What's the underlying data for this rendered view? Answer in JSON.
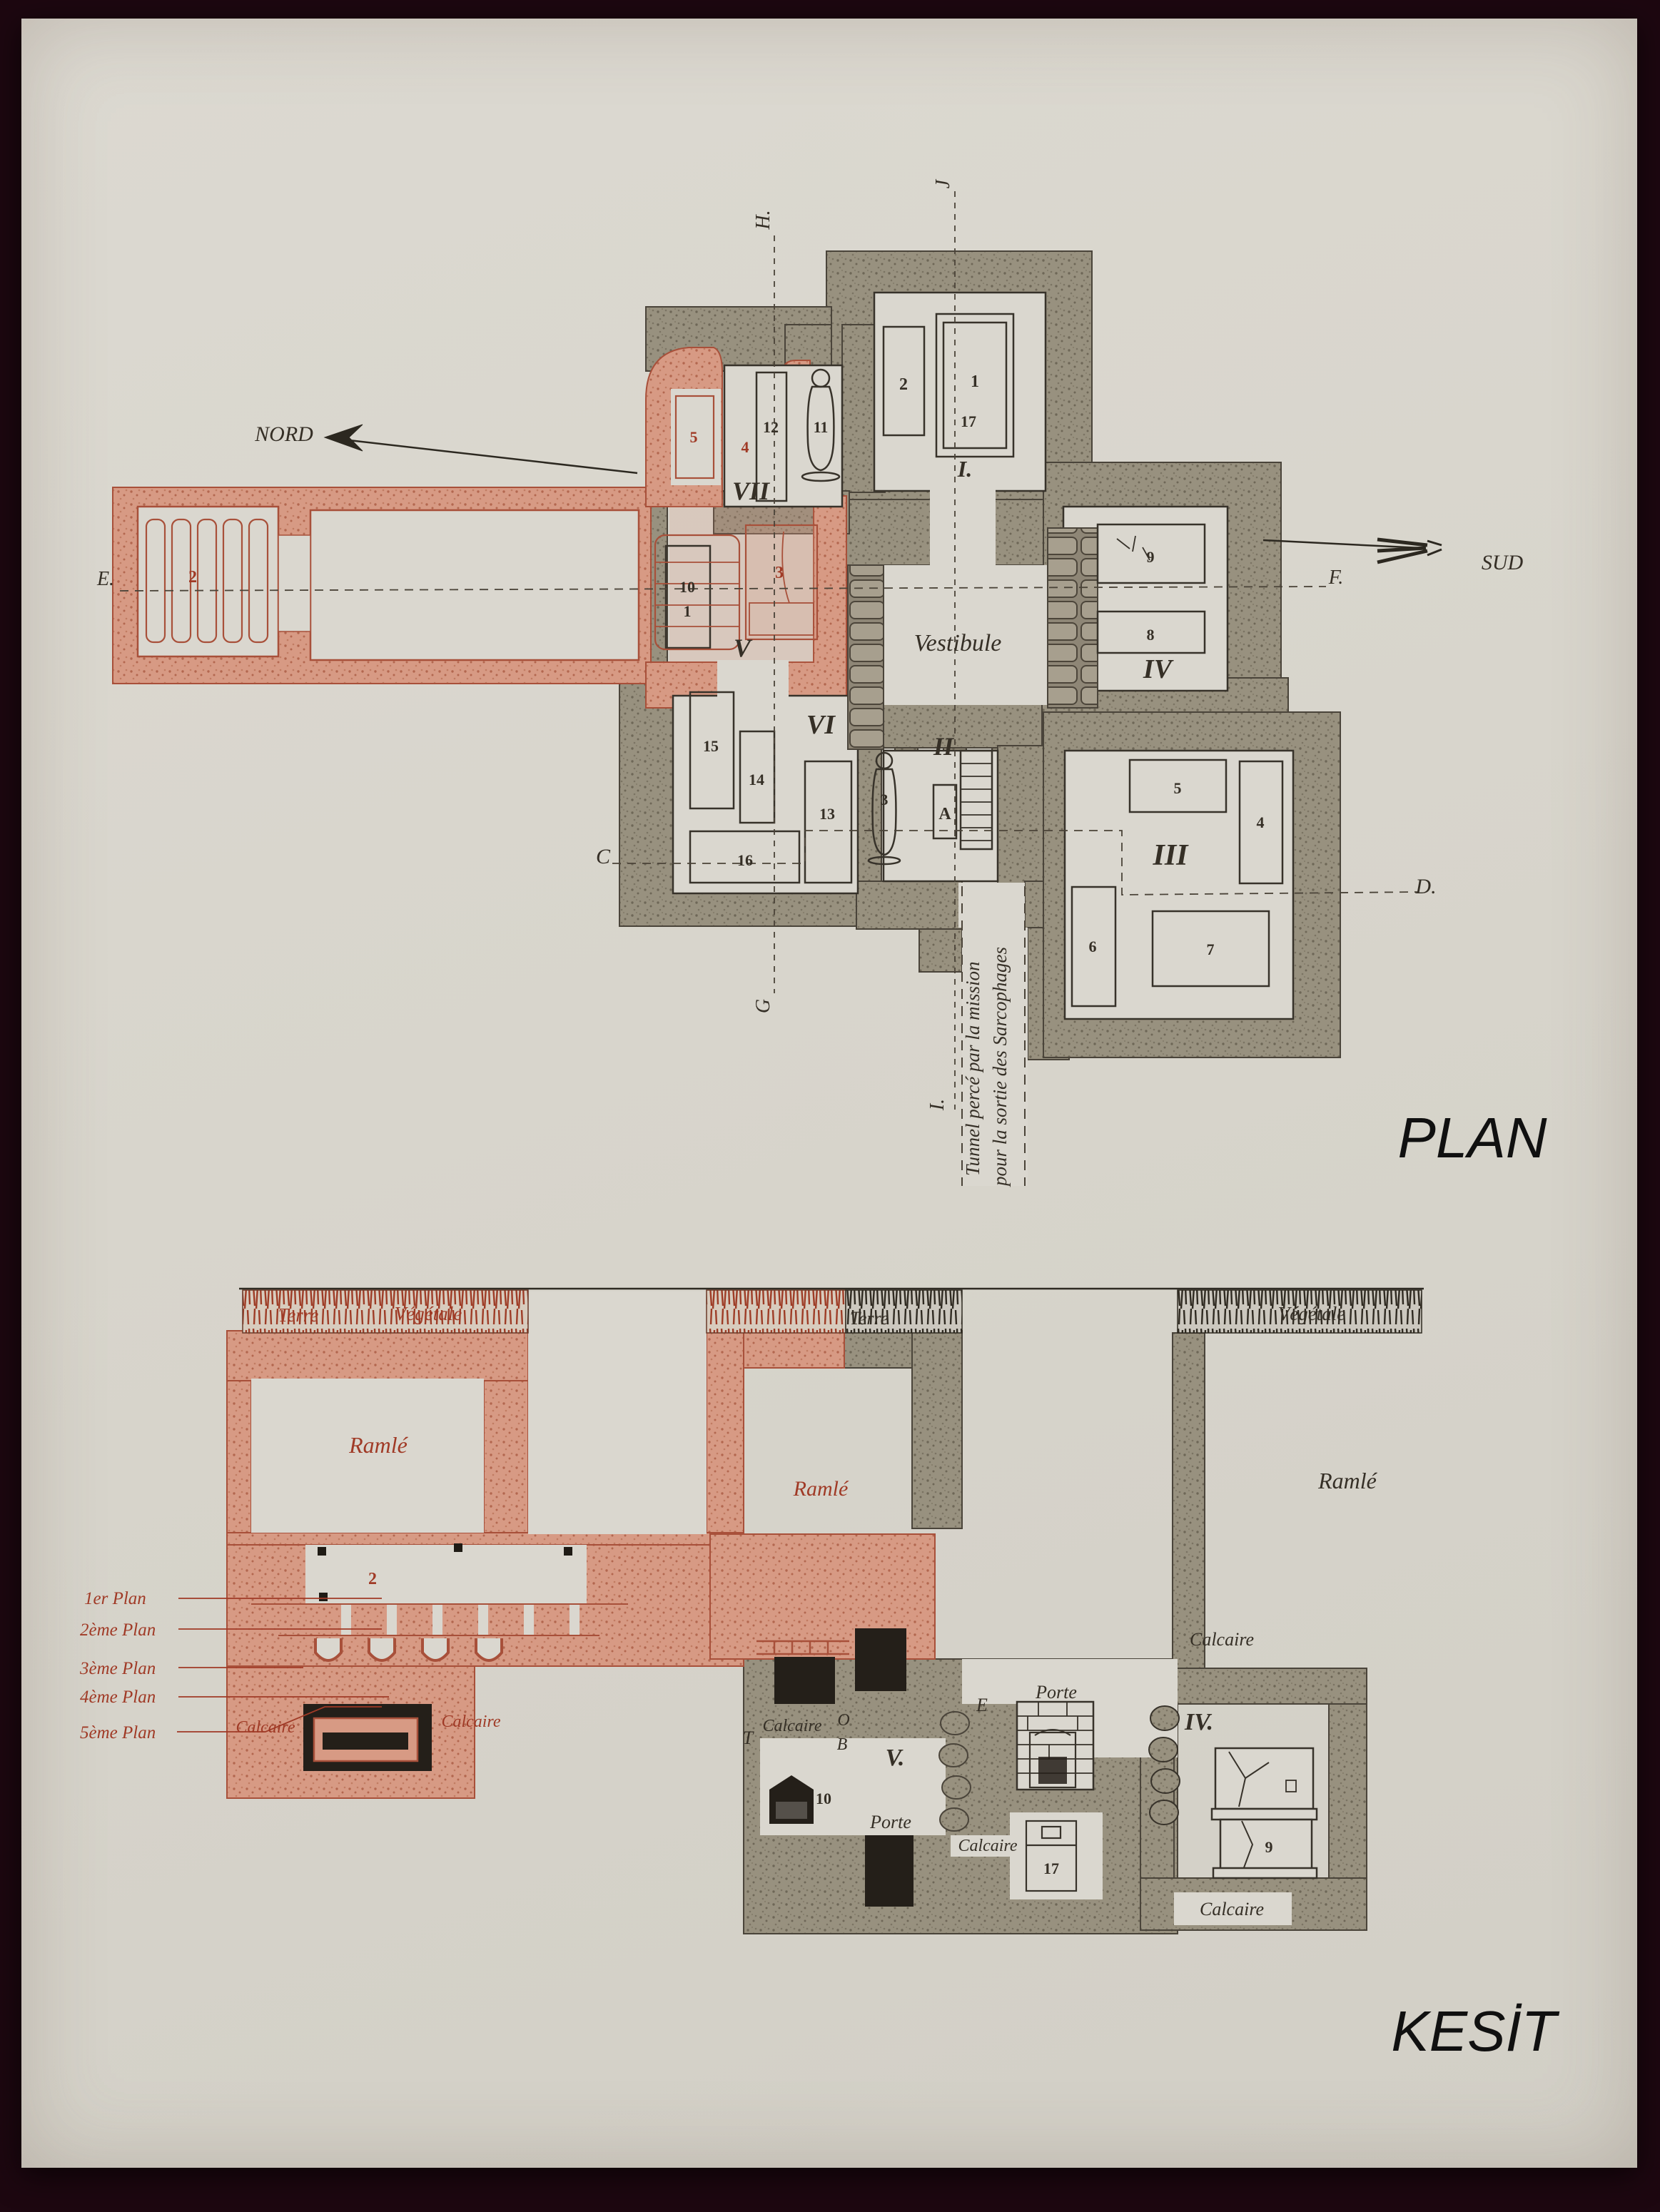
{
  "page": {
    "plan_caption": "PLAN",
    "section_caption": "KESİT"
  },
  "compass": {
    "north": "NORD",
    "south": "SUD"
  },
  "plan": {
    "vestibule_label": "Vestibule",
    "tunnel_note_line1": "Tunnel percé par la mission",
    "tunnel_note_line2": "pour la sortie des Sarcophages",
    "letters": {
      "E": "E.",
      "F": "F.",
      "C": "C",
      "D": "D.",
      "G": "G",
      "H": "H.",
      "J": "J",
      "I": "I."
    },
    "rooms": {
      "I": "I.",
      "II": "II",
      "III": "III",
      "IV": "IV",
      "V": "V",
      "VI": "VI",
      "VII": "VII"
    },
    "numbers": {
      "cI_2": "2",
      "cI_1": "1",
      "cI_17": "17",
      "gal_2": "2",
      "vii_5": "5",
      "vii_12": "12",
      "vii_4": "4",
      "vii_11": "11",
      "v_10": "10",
      "v_1": "1",
      "v_3": "3",
      "iv_9": "9",
      "iv_8": "8",
      "vi_15": "15",
      "vi_14": "14",
      "vi_13": "13",
      "vi_16": "16",
      "ii_3": "3",
      "ii_A": "A",
      "iii_5": "5",
      "iii_4": "4",
      "iii_6": "6",
      "iii_7": "7"
    }
  },
  "section": {
    "soil": {
      "terre_red": "Terre",
      "vegetale_red": "Végétale",
      "terre_black": "Terre",
      "vegetale_black": "Végétale"
    },
    "strata": {
      "ramle_left": "Ramlé",
      "ramle_mid": "Ramlé",
      "ramle_right": "Ramlé",
      "calcaire_red_1": "Calcaire",
      "calcaire_red_2": "Calcaire",
      "calcaire_mid_1": "Calcaire",
      "calcaire_mid_2": "Calcaire",
      "calcaire_right": "Calcaire",
      "calcaire_bottom": "Calcaire"
    },
    "doors": {
      "porte_v": "Porte",
      "porte_blocked": "Porte"
    },
    "letters": {
      "T": "T",
      "O": "O",
      "B": "B",
      "E": "E"
    },
    "rooms": {
      "V": "V.",
      "IV": "IV."
    },
    "numbers": {
      "s2": "2",
      "s10": "10",
      "s17": "17",
      "s9": "9"
    },
    "levels": [
      "1er Plan",
      "2ème Plan",
      "3ème Plan",
      "4ème Plan",
      "5ème Plan"
    ]
  }
}
